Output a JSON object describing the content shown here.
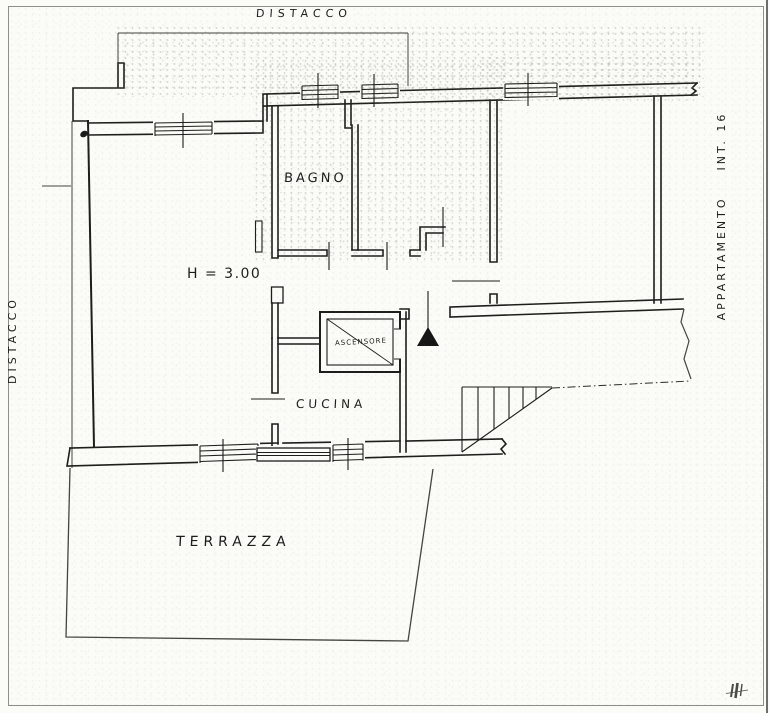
{
  "page": {
    "type": "scanned hand-drawn floor plan",
    "language": "Italian"
  },
  "labels": {
    "distacco_top": "DISTACCO",
    "distacco_left": "DISTACCO",
    "apartment_right": "APPARTAMENTO    INT. 16",
    "bagno": "BAGNO",
    "ceiling_height": "H = 3.00",
    "ascensore": "ASCENSORE",
    "cucina": "CUCINA",
    "terrazza": "TERRAZZA"
  },
  "symbols": {
    "entrance_marker": "filled-triangle",
    "elevator_shaft": "box-with-diagonal-cross",
    "staircase": "treads-with-cut-line",
    "window": "double-line-with-tick",
    "property_boundary": "thin-line"
  },
  "colors": {
    "paper": "#fbfbf7",
    "ink": "#1d1d1b",
    "noise": "#8a887e"
  }
}
